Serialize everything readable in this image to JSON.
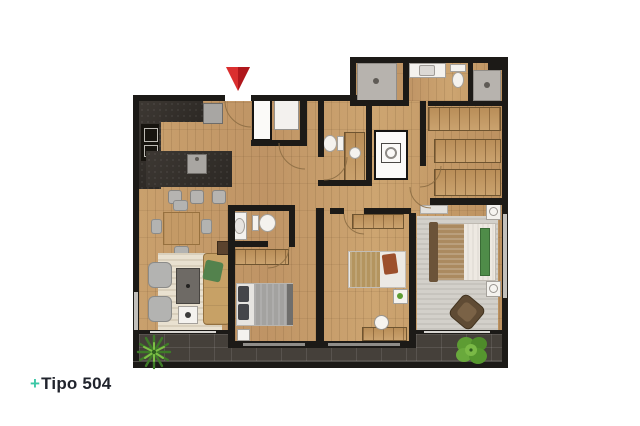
{
  "caption": {
    "prefix": "+",
    "label": "Tipo 504"
  },
  "colors": {
    "accent": "#3cc7a6",
    "caption_text": "#21242d",
    "wall": "#1c1a17",
    "wood": "#c79e6b",
    "counter_dark": "#332f2a",
    "tile": "#45403a",
    "window": "#c2c0bc",
    "fixture": "#f4f2ee",
    "shower": "#b7b3ae",
    "rug_living": "#e9e1d0",
    "rug_master": "#d3d0ca",
    "sofa_tan": "#c7a166",
    "bed_green": "#4f8c49",
    "plant_green": "#5d9c33",
    "marker_red": "#d01f24"
  },
  "icons": {
    "entrance_marker": "red-arrow-down",
    "balcony_plants": [
      "spiky-plant",
      "leafy-plant"
    ],
    "fixtures": [
      "toilet",
      "sink",
      "shower-drain",
      "washer",
      "fridge",
      "table-lamp"
    ]
  }
}
